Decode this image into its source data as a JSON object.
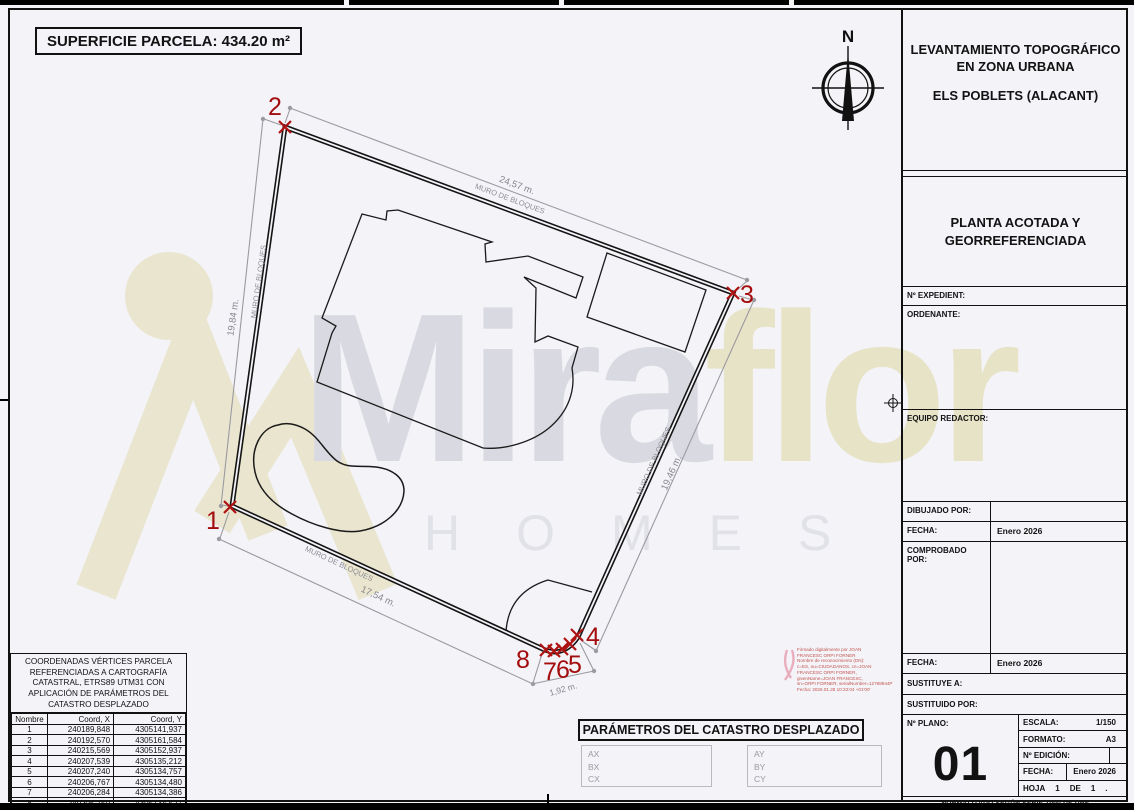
{
  "sheet": {
    "superficie_label": "SUPERFICIE PARCELA: 434.20 m²"
  },
  "watermark": {
    "word1": "Mira",
    "word2": "flor",
    "homes": "HOMES"
  },
  "plan": {
    "north": "N",
    "wall_label": "MURO DE BLOQUES",
    "dim_top": "24,57 m.",
    "dim_left": "19,84 m.",
    "dim_right": "19,46 m.",
    "dim_bottom": "17,54 m.",
    "dim_corner": "1,92 m.",
    "vertices": [
      "1",
      "2",
      "3",
      "4",
      "5",
      "6",
      "7",
      "8"
    ]
  },
  "title_block": {
    "title_line1": "LEVANTAMIENTO TOPOGRÁFICO",
    "title_line2": "EN ZONA URBANA",
    "location": "ELS POBLETS (ALACANT)",
    "subtitle_line1": "PLANTA ACOTADA Y",
    "subtitle_line2": "GEORREFERENCIADA",
    "expediente_label": "Nº EXPEDIENT:",
    "ordenante_label": "ORDENANTE:",
    "equipo_label": "EQUIPO REDACTOR:",
    "dibujado_label": "DIBUJADO POR:",
    "fecha_label": "FECHA:",
    "fecha1_value": "Enero 2026",
    "comprobado_label": "COMPROBADO POR:",
    "fecha2_value": "Enero 2026",
    "sustituye_label": "SUSTITUYE A:",
    "sustituido_label": "SUSTITUIDO POR:",
    "plano_label": "Nº PLANO:",
    "plano_number": "01",
    "escala_label": "ESCALA:",
    "escala_value": "1/150",
    "formato_label": "FORMATO:",
    "formato_value": "A3",
    "edicion_label": "Nº EDICIÓN:",
    "edicion_value": "",
    "fecha3_label": "FECHA:",
    "fecha3_value": "Enero 2026",
    "hoja_label": "HOJA",
    "hoja_num": "1",
    "hoja_de": "DE",
    "hoja_total": "1",
    "hoja_suffix": ".",
    "norma": "NORMALIZADO SEGÚN SERIE 1000 DE UNE"
  },
  "coords_table": {
    "title_lines": [
      "COORDENADAS VÉRTICES PARCELA",
      "REFERENCIADAS A CARTOGRAFÍA",
      "CATASTRAL, ETRS89 UTM31 CON",
      "APLICACIÓN DE PARÁMETROS DEL",
      "CATASTRO DESPLAZADO"
    ],
    "headers": [
      "Nombre",
      "Coord, X",
      "Coord, Y"
    ],
    "rows": [
      [
        "1",
        "240189,848",
        "4305141,937"
      ],
      [
        "2",
        "240192,570",
        "4305161,584"
      ],
      [
        "3",
        "240215,569",
        "4305152,937"
      ],
      [
        "4",
        "240207,539",
        "4305135,212"
      ],
      [
        "5",
        "240207,240",
        "4305134,757"
      ],
      [
        "6",
        "240206,767",
        "4305134,480"
      ],
      [
        "7",
        "240206,284",
        "4305134,386"
      ],
      [
        "8",
        "240205,750",
        "4305134,527"
      ]
    ]
  },
  "parametros": {
    "title": "PARÁMETROS DEL CATASTRO DESPLAZADO",
    "left": [
      "AX",
      "BX",
      "CX"
    ],
    "right": [
      "AY",
      "BY",
      "CY"
    ]
  },
  "signature": {
    "lines": [
      "Firmado digitalmente por JOAN",
      "FRANCESC ORPI FORNER",
      "Nombre de reconocimiento (DN):",
      "c=ES, ou=CIUDADANOS, cn=JOAN",
      "FRANCESC ORPI FORNER,",
      "givenName=JOAN FRANCESC,",
      "sn=ORPI FORNER, serialNumber=12788944P",
      "Fecha: 2026.01.28 10:23:04 +01'00'"
    ]
  }
}
